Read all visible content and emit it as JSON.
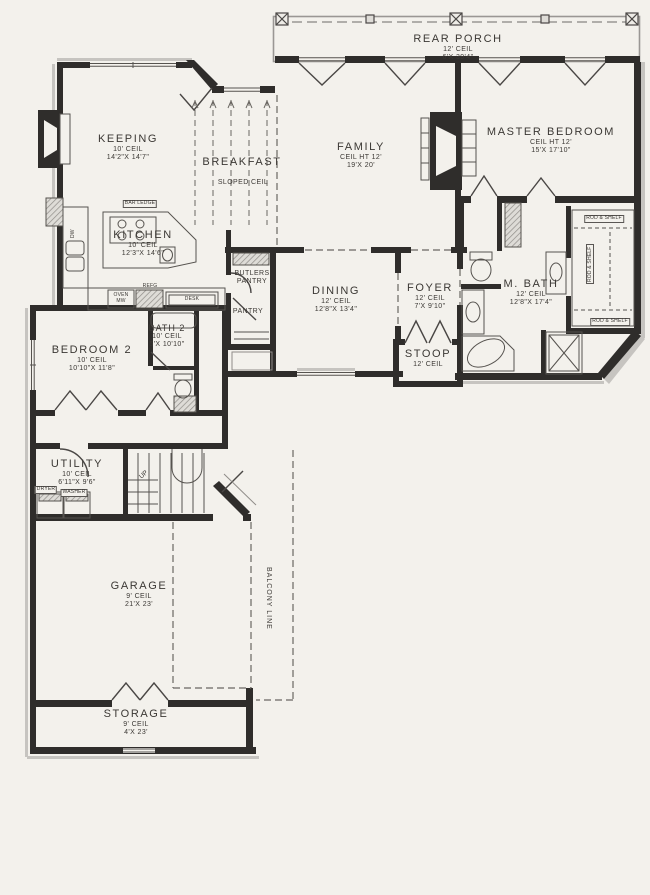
{
  "plan_title": "first-floor-plan",
  "colors": {
    "paper": "#f3f1ec",
    "wall": "#2f2d2b",
    "line": "#56534f",
    "trim": "#c6c4c0",
    "dash": "#6a6762"
  },
  "rooms": {
    "rear_porch": {
      "name": "REAR PORCH",
      "ceil": "12' CEIL",
      "dims": "6'X 39'4\""
    },
    "keeping": {
      "name": "KEEPING",
      "ceil": "10' CEIL",
      "dims": "14'2\"X 14'7\""
    },
    "breakfast": {
      "name": "BREAKFAST",
      "ceil": "SLOPED CEIL"
    },
    "family": {
      "name": "FAMILY",
      "ceil": "CEIL HT 12'",
      "dims": "19'X 20'"
    },
    "master_bedroom": {
      "name": "MASTER BEDROOM",
      "ceil": "CEIL HT 12'",
      "dims": "15'X 17'10\""
    },
    "kitchen": {
      "name": "KITCHEN",
      "ceil": "10' CEIL",
      "dims": "12'3\"X 14'6\""
    },
    "butlers_pantry": {
      "line1": "BUTLERS",
      "line2": "PANTRY"
    },
    "pantry": {
      "name": "PANTRY"
    },
    "dining": {
      "name": "DINING",
      "ceil": "12' CEIL",
      "dims": "12'8\"X 13'4\""
    },
    "foyer": {
      "name": "FOYER",
      "ceil": "12' CEIL",
      "dims": "7'X 9'10\""
    },
    "stoop": {
      "name": "STOOP",
      "ceil": "12' CEIL"
    },
    "master_bath": {
      "name": "M. BATH",
      "ceil": "12' CEIL",
      "dims": "12'8\"X 17'4\""
    },
    "bedroom_2": {
      "name": "BEDROOM 2",
      "ceil": "10' CEIL",
      "dims": "10'10\"X 11'8\""
    },
    "bath_2": {
      "name": "BATH 2",
      "ceil": "10' CEIL",
      "dims": "5'X 10'10\""
    },
    "utility": {
      "name": "UTILITY",
      "ceil": "10' CEIL",
      "dims": "6'11\"X 9'6\""
    },
    "garage": {
      "name": "GARAGE",
      "ceil": "9' CEIL",
      "dims": "21'X 23'"
    },
    "storage": {
      "name": "STORAGE",
      "ceil": "9' CEIL",
      "dims": "4'X 23'"
    }
  },
  "annotations": {
    "balcony_line": "BALCONY LINE",
    "bar_ledge": "BAR LEDGE",
    "rod_shelf": "ROD & SHELF",
    "up": "UP",
    "dw": "DW",
    "oven": "OVEN",
    "mw": "MW",
    "refg": "REFG",
    "desk": "DESK",
    "dryer": "DRYER",
    "washer": "WASHER"
  }
}
